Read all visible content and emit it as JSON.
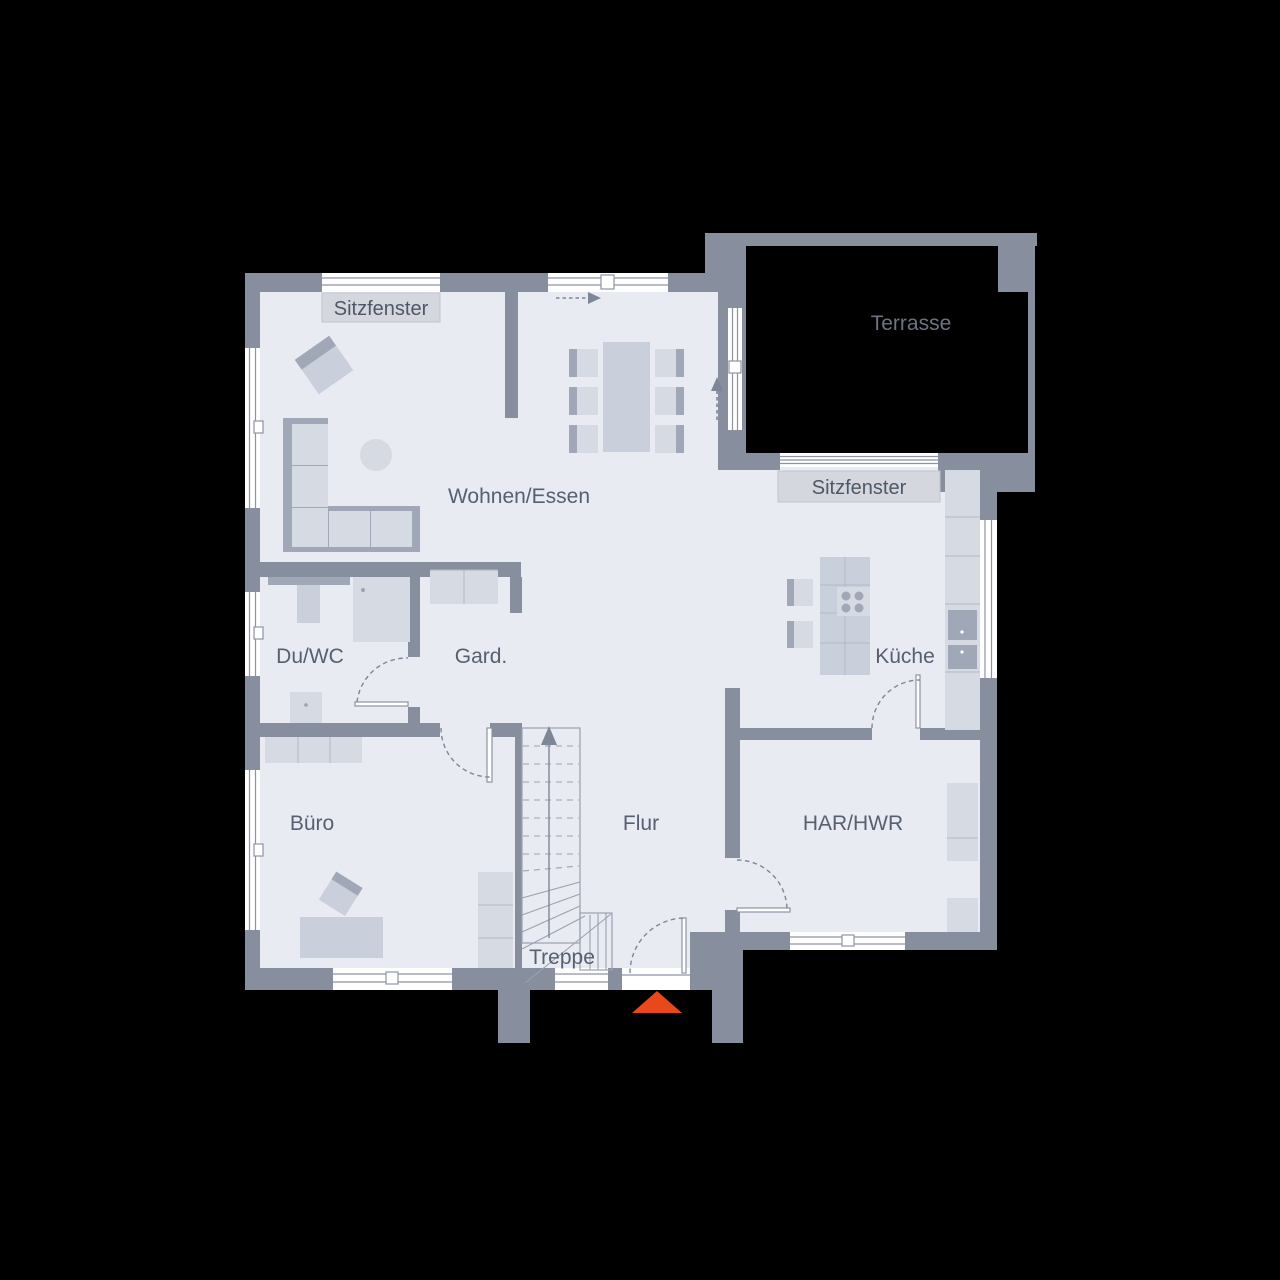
{
  "colors": {
    "background": "#000000",
    "wall": "#878f9f",
    "floor": "#e8ebf1",
    "furniture": "#d6dae3",
    "furniture_mid": "#c9cfdb",
    "furniture_dark": "#a0a8b8",
    "furniture_line": "#b2b8c5",
    "window_line": "#8c94a4",
    "stair_line": "#9aa2b0",
    "dash": "#7e8796",
    "label_box": "#d4d7de",
    "label_box_border": "#c2c6ce",
    "label_text": "#4d5867",
    "room_text": "#566070",
    "terrace_text": "#6c7380",
    "entrance_marker": "#e8481c"
  },
  "labels": {
    "sitzfenster_top": "Sitzfenster",
    "terrasse": "Terrasse",
    "wohnen_essen": "Wohnen/Essen",
    "sitzfenster_right": "Sitzfenster",
    "du_wc": "Du/WC",
    "gard": "Gard.",
    "kueche": "Küche",
    "buero": "Büro",
    "flur": "Flur",
    "har_hwr": "HAR/HWR",
    "treppe": "Treppe"
  }
}
